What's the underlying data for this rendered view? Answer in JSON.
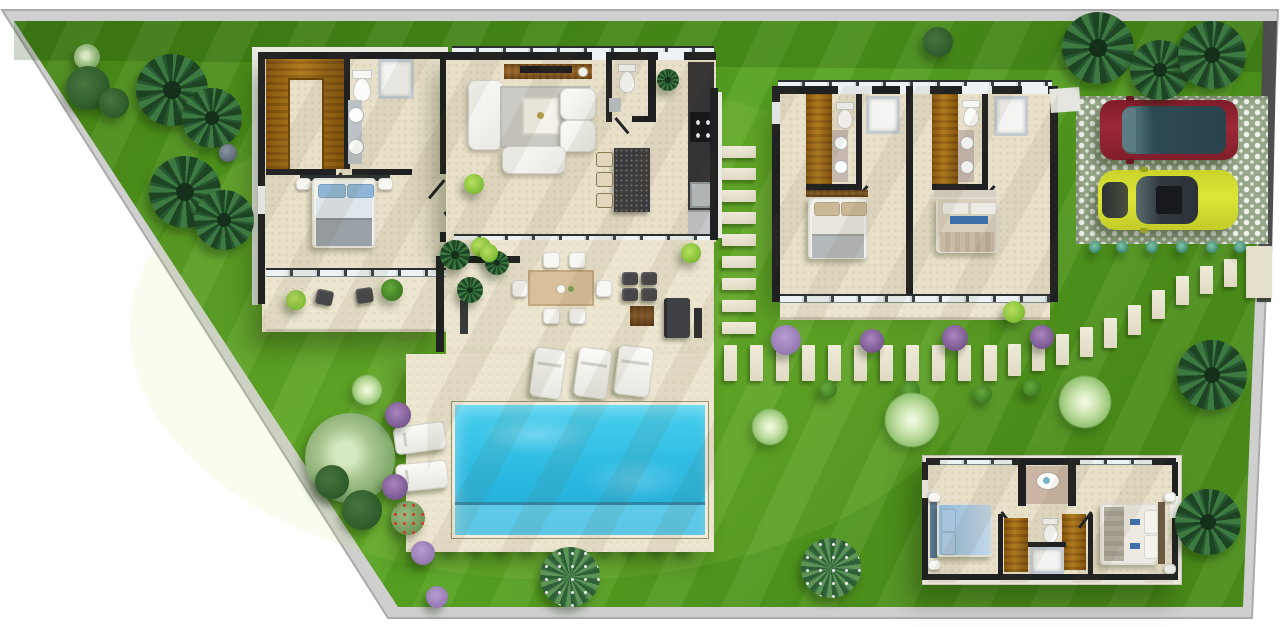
{
  "meta": {
    "title": "Top-view 3D site plan of a modern villa with pool, garden, guest house and driveway"
  },
  "palette": {
    "lawn": "#52981e",
    "lawn_dark": "#3e7d16",
    "boundary_wall": "#cfcfcf",
    "boundary_wall_dark": "#4e4e4e",
    "house_wall": "#1f2022",
    "floor": "#e8e0c9",
    "deck": "#ece5cf",
    "wood": "#a06a14",
    "pool_water": "#2ab8e0",
    "pool_shelf": "#9fe6f4",
    "kitchen_stone": "#3a3a3c",
    "car_red": "#8f212e",
    "car_yellow": "#d7dd2e",
    "car_glass": "#33505b",
    "slab": "#ece7d4",
    "purple_shrub": "#7c5a92"
  },
  "buildings": {
    "main_house": {
      "rooms": [
        "walk-in-closet",
        "master-bathroom",
        "master-bedroom",
        "master-terrace",
        "living-room",
        "guest-wc",
        "kitchen",
        "bedroom-suite-1",
        "suite-1-bathroom",
        "bedroom-suite-2",
        "suite-2-bathroom"
      ]
    },
    "guest_house": {
      "rooms": [
        "guest-bedroom-left",
        "guest-bathroom",
        "guest-bedroom-right"
      ]
    }
  },
  "amenities": [
    "swimming-pool",
    "sun-deck",
    "outdoor-dining-table",
    "outdoor-lounge-set",
    "sun-loungers",
    "driveway",
    "stepping-stone-paths",
    "perimeter-wall"
  ],
  "vehicles": [
    {
      "name": "suv",
      "body_color": "#8f212e",
      "glass_color": "#2f4b55"
    },
    {
      "name": "sports-car",
      "body_color": "#d7dd2e",
      "glass_color": "#31383e"
    }
  ],
  "counts": {
    "sun_loungers_deck": 3,
    "sun_loungers_lawn": 2,
    "dining_chairs": 6,
    "kitchen_stools": 3,
    "bedrooms_main": 3,
    "bedrooms_guest": 2
  },
  "garden": {
    "plants": [
      [
        "tree",
        87,
        57,
        13
      ],
      [
        "bush-dark",
        88,
        88,
        22
      ],
      [
        "bush-dark",
        114,
        103,
        15
      ],
      [
        "palm",
        172,
        90,
        36
      ],
      [
        "palm",
        212,
        118,
        30
      ],
      [
        "palm",
        185,
        192,
        36
      ],
      [
        "palm",
        224,
        220,
        30
      ],
      [
        "rock",
        228,
        153,
        9
      ],
      [
        "puff",
        367,
        390,
        15
      ],
      [
        "tree",
        350,
        458,
        45
      ],
      [
        "bush-dark",
        332,
        482,
        17
      ],
      [
        "bush-dark",
        362,
        510,
        20
      ],
      [
        "flower-red",
        408,
        518,
        17
      ],
      [
        "purple",
        398,
        415,
        13
      ],
      [
        "purple",
        395,
        487,
        13
      ],
      [
        "lavender",
        423,
        553,
        12
      ],
      [
        "lavender",
        437,
        597,
        11
      ],
      [
        "palm",
        455,
        255,
        15
      ],
      [
        "bush-light",
        481,
        247,
        10
      ],
      [
        "palm",
        470,
        290,
        13
      ],
      [
        "palm",
        497,
        263,
        12
      ],
      [
        "bush-light",
        474,
        184,
        10
      ],
      [
        "bush-light",
        489,
        253,
        9
      ],
      [
        "bush-light",
        691,
        253,
        10
      ],
      [
        "palm",
        668,
        80,
        11
      ],
      [
        "lavender",
        786,
        340,
        15
      ],
      [
        "purple",
        872,
        341,
        12
      ],
      [
        "purple",
        955,
        338,
        13
      ],
      [
        "purple",
        1042,
        337,
        12
      ],
      [
        "bush",
        828,
        389,
        9
      ],
      [
        "bush",
        910,
        391,
        10
      ],
      [
        "bush",
        983,
        394,
        9
      ],
      [
        "bush",
        1032,
        388,
        9
      ],
      [
        "puff",
        770,
        427,
        18
      ],
      [
        "puff",
        912,
        420,
        27
      ],
      [
        "puff",
        1085,
        402,
        26
      ],
      [
        "bush-light",
        1014,
        312,
        11
      ],
      [
        "palm",
        1098,
        48,
        36
      ],
      [
        "palm",
        1160,
        70,
        30
      ],
      [
        "palm",
        1212,
        55,
        34
      ],
      [
        "bush-dark",
        938,
        42,
        15
      ],
      [
        "palm",
        1212,
        375,
        35
      ],
      [
        "palm",
        1208,
        522,
        33
      ],
      [
        "agave",
        570,
        577,
        30
      ],
      [
        "agave",
        831,
        568,
        30
      ],
      [
        "aloe",
        1095,
        247,
        6
      ],
      [
        "aloe",
        1122,
        247,
        6
      ],
      [
        "aloe",
        1152,
        247,
        6
      ],
      [
        "aloe",
        1182,
        247,
        6
      ],
      [
        "aloe",
        1212,
        247,
        6
      ],
      [
        "aloe",
        1240,
        247,
        6
      ]
    ]
  },
  "paths": {
    "vertical": {
      "x": 722,
      "w": 34,
      "h": 12,
      "ys": [
        146,
        168,
        190,
        212,
        234,
        256,
        278,
        300,
        322
      ]
    },
    "horizontal": {
      "y": 345,
      "w": 13,
      "h": 36,
      "xs": [
        724,
        750,
        776,
        802,
        828,
        854,
        880,
        906,
        932,
        958,
        984
      ]
    },
    "diagonal": [
      [
        1008,
        344,
        32
      ],
      [
        1032,
        340,
        31
      ],
      [
        1056,
        334,
        31
      ],
      [
        1080,
        327,
        30
      ],
      [
        1104,
        318,
        30
      ],
      [
        1128,
        305,
        30
      ],
      [
        1152,
        290,
        29
      ],
      [
        1176,
        276,
        29
      ],
      [
        1200,
        266,
        28
      ],
      [
        1224,
        259,
        28
      ]
    ],
    "pool_bushes": {
      "y": 543,
      "xs": [
        452,
        478,
        504,
        530,
        556,
        582,
        608,
        634,
        660,
        686
      ]
    }
  }
}
